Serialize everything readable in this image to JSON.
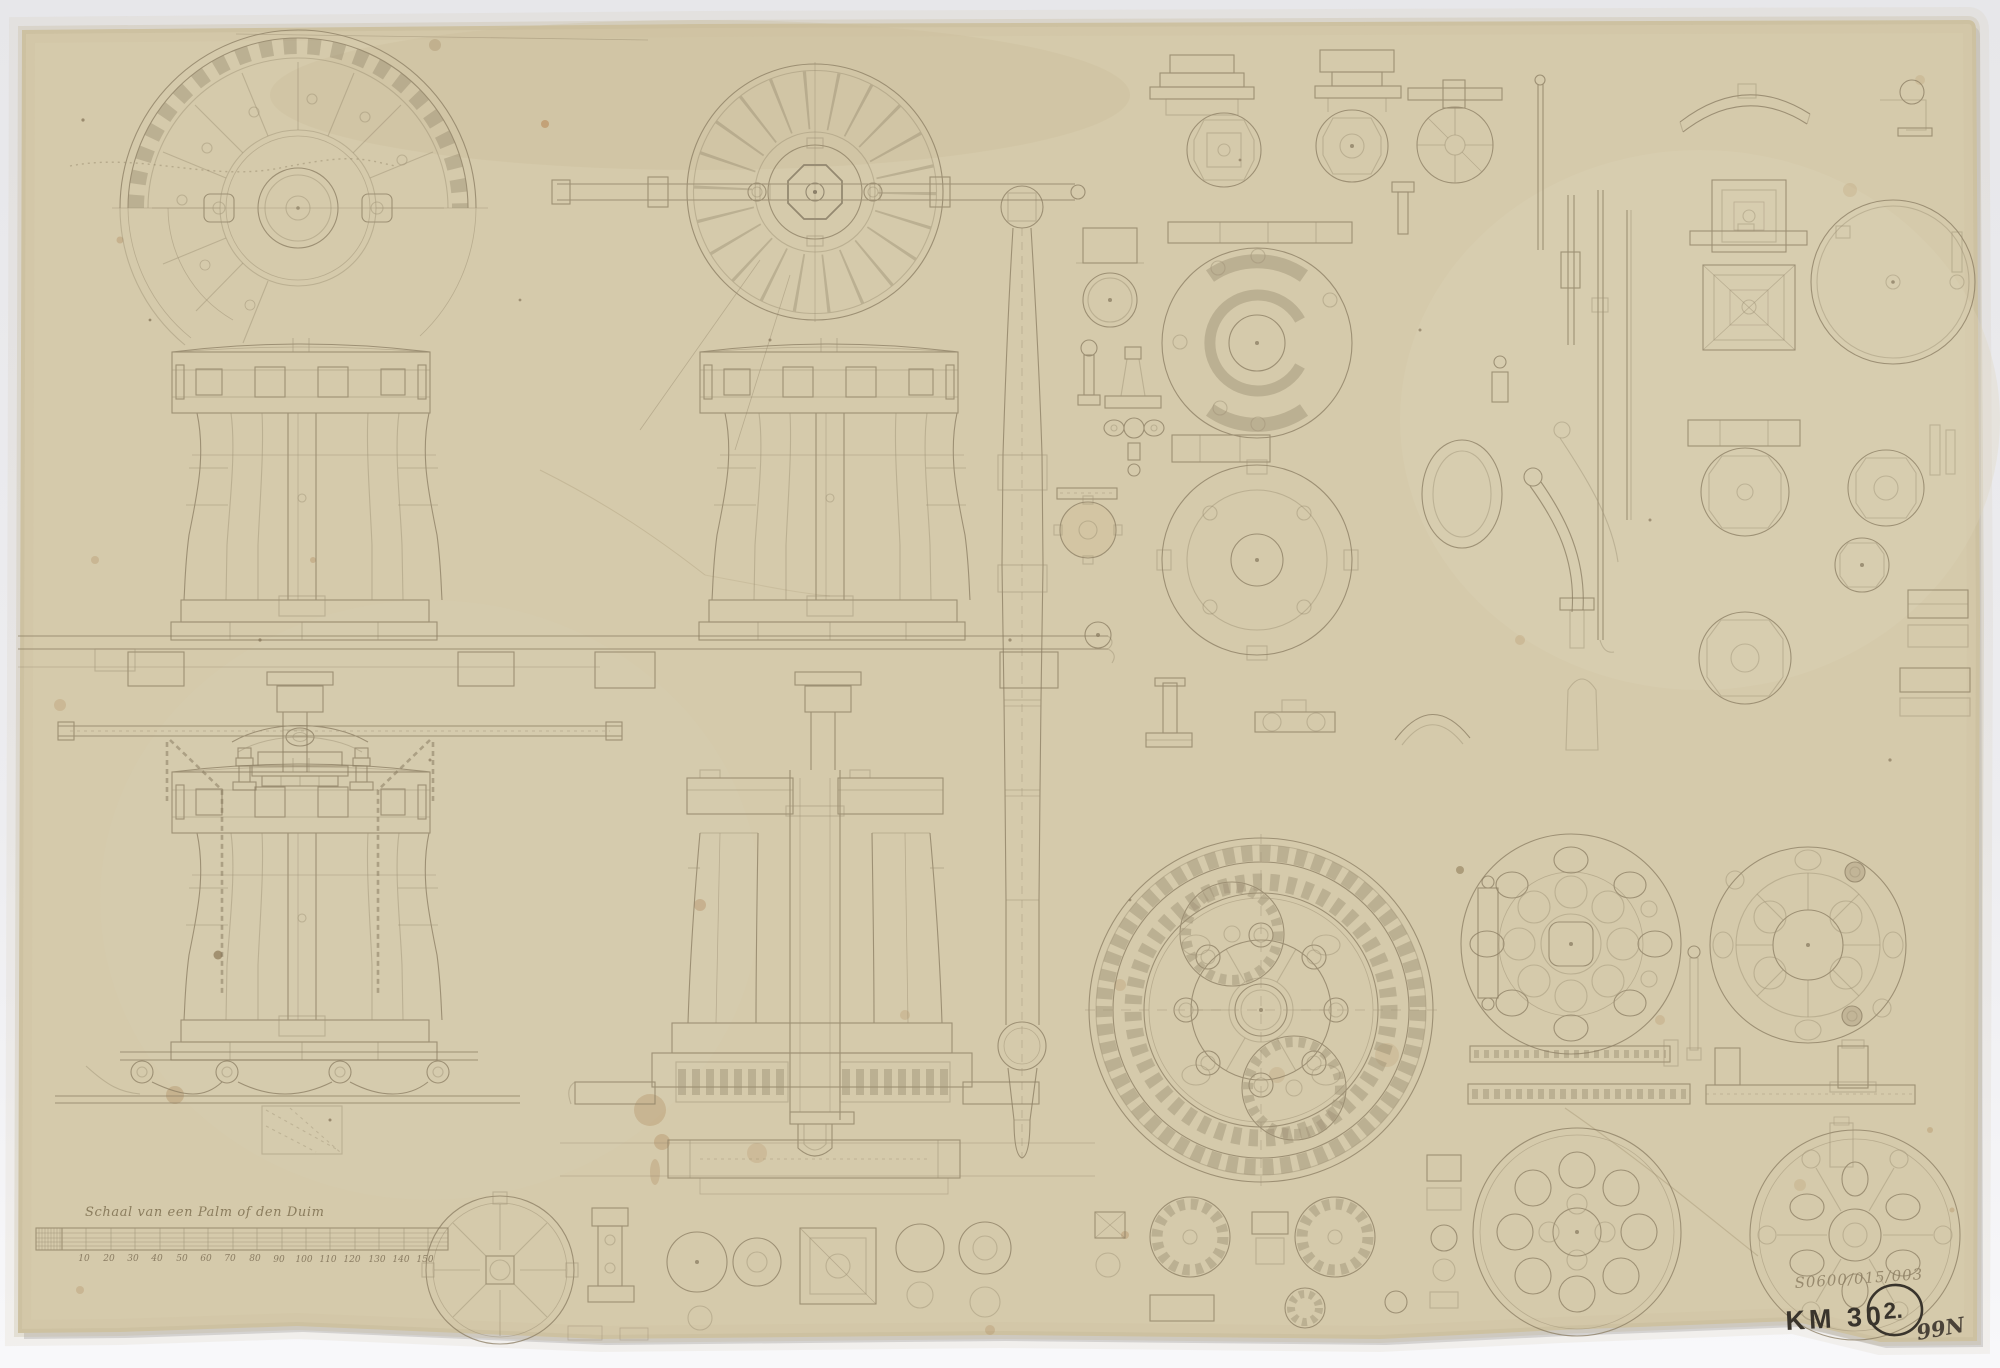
{
  "annotations": {
    "scale_caption": "Schaal van een Palm of den Duim",
    "scale_ticks": [
      "10",
      "20",
      "30",
      "40",
      "50",
      "60",
      "70",
      "80",
      "90",
      "100",
      "110",
      "120",
      "130",
      "140",
      "150"
    ],
    "inventory_inscription": "S0600/015/003",
    "collection_code": "KM 30",
    "sheet_number": "2.",
    "corner_mark": "99N"
  },
  "palette": {
    "backdrop_top": "#e7e7ea",
    "backdrop_bottom": "#f8f8fa",
    "paper": "#d5caab",
    "paper_edge": "#c3b795",
    "pencil_line": "#8a7c62",
    "dark_ink": "#39342c",
    "pencil_note": "#8d7f63",
    "stain": "#a87c4b"
  },
  "figure_names": [
    "capstan-head-half-plan",
    "capstan-plan-with-bar",
    "capstan-elevation-upper-left",
    "capstan-elevation-upper-center",
    "capstan-elevation-lower-with-chains",
    "capstan-section-lower-center",
    "capstan-spindle-elevation",
    "small-fittings-column",
    "pawl-rods-and-link",
    "top-right-detail-plates",
    "main-gear-wheel-plan",
    "pinion-gears",
    "rack-bars",
    "trundle-head-plates",
    "base-plates",
    "bottom-detail-row",
    "scale-bar"
  ]
}
